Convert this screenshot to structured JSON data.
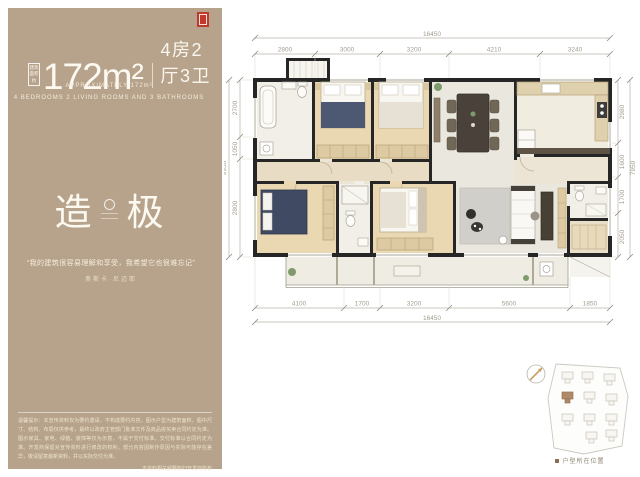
{
  "panel": {
    "area_badge_line1": "建筑",
    "area_badge_line2": "面积",
    "area_badge_line3": "约",
    "area_value": "172m²",
    "unit_layout": "4房2厅3卫",
    "caption1": "APPROXIMATELY 172m²",
    "caption2": "4 BEDROOMS 2 LIVING ROOMS AND 3 BATHROOMS",
    "logo_char1": "造",
    "logo_char2": "极",
    "quote": "“我的建筑很容易理解和享受，我希望它也很难忘记”",
    "author": "奥斯卡·尼迈耶",
    "disclaimer": "温馨提示：本宣传资料仅为要约邀请，不构成要约内容。图示户型为建筑面积，图中尺寸、结构、布局仅供参考，最终以政府主管部门批准文件及商品房买卖合同约定为准。图示家具、家电、绿植、装饰等仅为示意，不属于交付标准，交付标准以合同约定为准。开发商保留对宣传资料进行修改的权利，部分内容因制作原因与实际可能存在差异，敬请留意最新资料，并以实际交付为准。",
    "footnote1": "本资料相关解释权归开发商所有",
    "footnote2": "资料制作时间：2024年"
  },
  "plan": {
    "dims": {
      "top_total": "16450",
      "top": [
        "2800",
        "3000",
        "3200",
        "4210",
        "3240"
      ],
      "bottom": [
        "4100",
        "1700",
        "3200",
        "5600",
        "1850"
      ],
      "bottom_total": "16450",
      "left": [
        "2700",
        "1050",
        "2800"
      ],
      "left_total": "9950",
      "right": [
        "2980",
        "1600",
        "1700",
        "2050"
      ],
      "right_total": "7950"
    }
  },
  "siteplan": {
    "caption": "户型所在位置"
  },
  "colors": {
    "panel_bg": "#b7a38b",
    "wall": "#262626",
    "wood_floor": "#ead8b2",
    "tile_floor": "#eae7de",
    "navy_bed": "#4d5872",
    "highlight_building": "#b08968",
    "seal_red": "#bf3a2b"
  }
}
